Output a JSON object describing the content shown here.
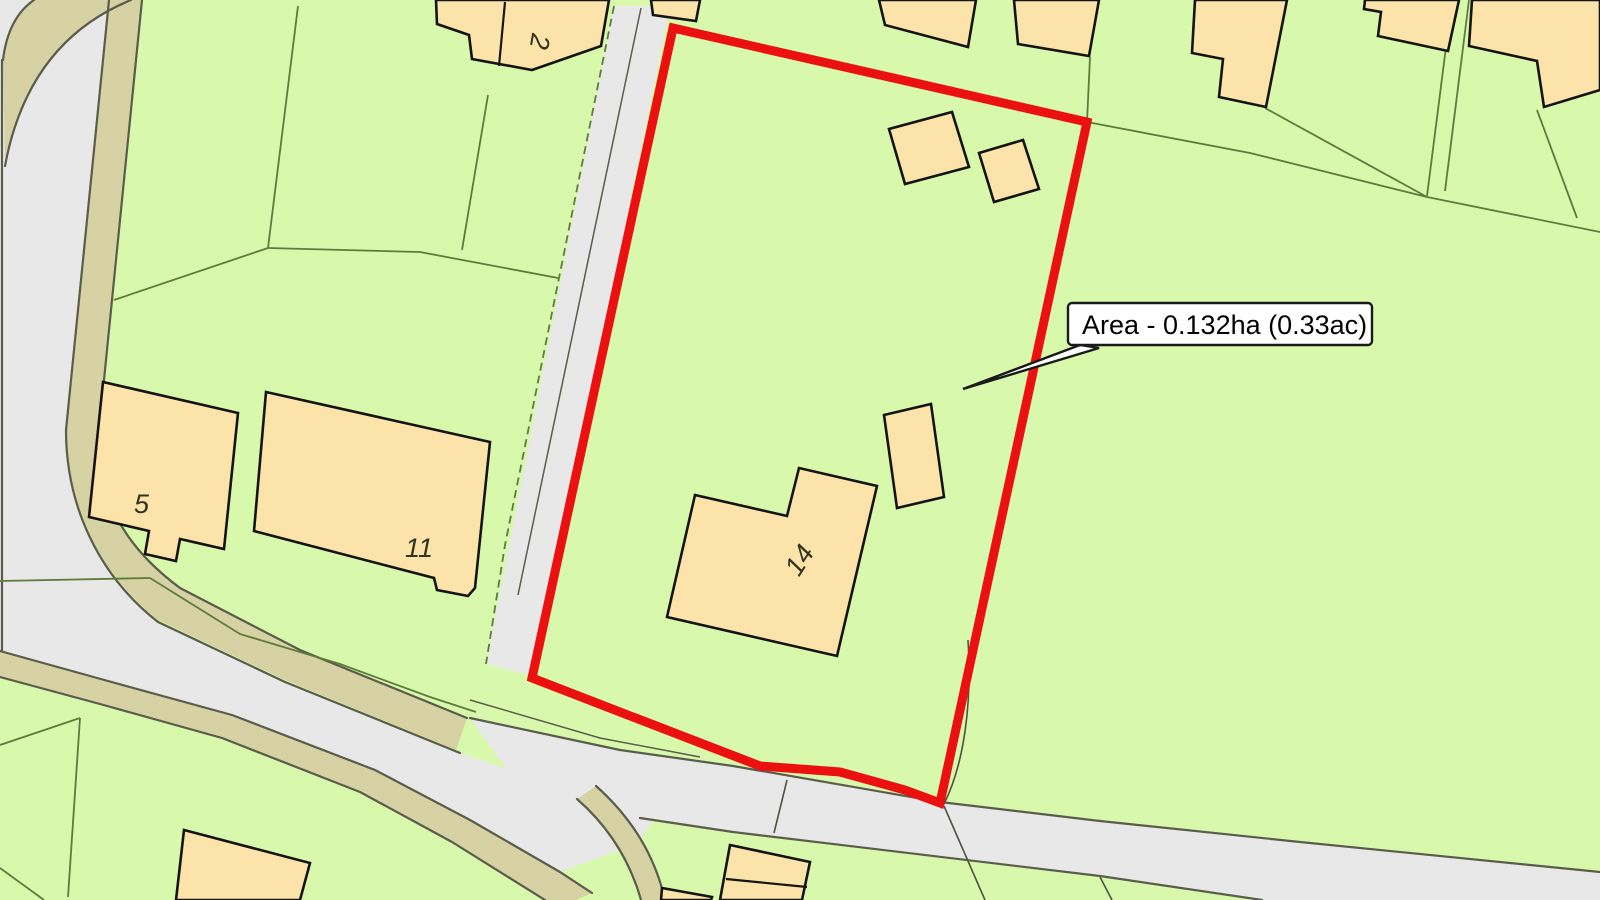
{
  "map": {
    "area_label": "Area - 0.132ha (0.33ac)",
    "house_numbers": {
      "h5": "5",
      "h11": "11",
      "h14": "14",
      "h2": "2"
    },
    "colors": {
      "parcel_green": "#d8f8ab",
      "building_fill": "#fbe3a9",
      "building_outline": "#141414",
      "road_gray": "#e8e8e9",
      "road_edge": "#5a5c4c",
      "verge_khaki": "#d7d2a4",
      "parcel_line": "#5d7c3c",
      "boundary_red": "#ec1111",
      "callout_bg": "#ffffff",
      "callout_border": "#1a1a1a"
    }
  }
}
